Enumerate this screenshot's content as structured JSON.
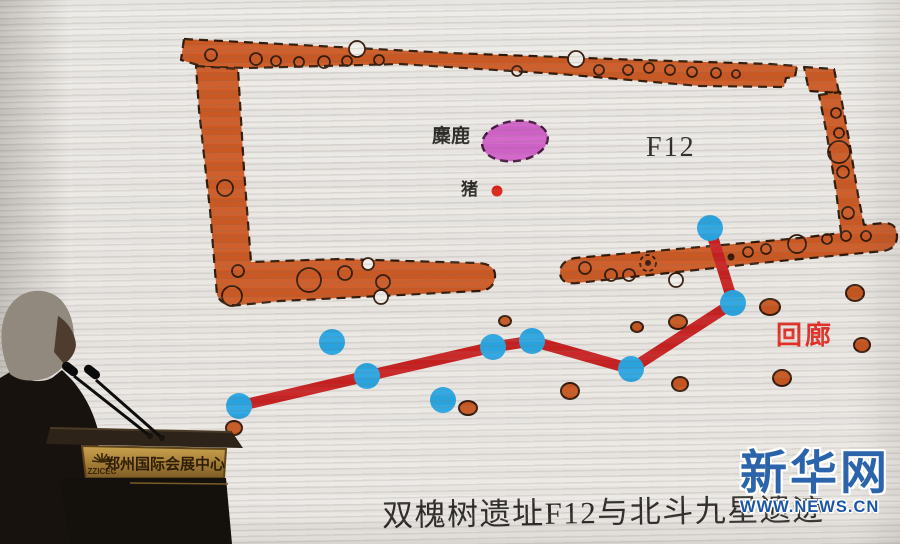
{
  "slide": {
    "caption": "双槐树遗址F12与北斗九星遗迹",
    "labels": {
      "elk": "麋鹿",
      "pig": "猪",
      "room": "F12",
      "corridor": "回廊"
    }
  },
  "watermark": {
    "brand": "新华网",
    "url": "WWW.NEWS.CN"
  },
  "podium": {
    "venue_abbr": "ZZICEC",
    "venue_name": "郑州国际会展中心"
  },
  "colors": {
    "screen_bg": "#eae7e3",
    "band_fill": "#cd5a24",
    "band_outline": "#2e1808",
    "posthole_outline": "#32190a",
    "star_fill": "#2aa6e2",
    "line_red": "#c92020",
    "elk_fill": "#d263c9",
    "elk_outline": "#46173f",
    "pig_red": "#dd2317",
    "pit_fill": "#c8561f",
    "pit_outline": "#33190a",
    "corridor_red": "#e33028",
    "caption_ink": "#2b2a28",
    "watermark_blue": "#2b64aa",
    "watermark_url_blue": "#1c57a5",
    "plaque_gold": "#c69c47"
  },
  "diagram": {
    "star_radius": 13,
    "stars": [
      {
        "x": 239,
        "y": 406,
        "connected": true
      },
      {
        "x": 367,
        "y": 376,
        "connected": true
      },
      {
        "x": 493,
        "y": 347,
        "connected": true
      },
      {
        "x": 532,
        "y": 341,
        "connected": true
      },
      {
        "x": 631,
        "y": 369,
        "connected": true
      },
      {
        "x": 733,
        "y": 303,
        "connected": true
      },
      {
        "x": 710,
        "y": 228,
        "connected": true
      },
      {
        "x": 332,
        "y": 342,
        "connected": false
      },
      {
        "x": 443,
        "y": 400,
        "connected": false
      }
    ],
    "connection_order": [
      0,
      1,
      2,
      3,
      4,
      5,
      6
    ],
    "pits": [
      {
        "x": 234,
        "y": 428,
        "rx": 8,
        "ry": 7
      },
      {
        "x": 505,
        "y": 321,
        "rx": 6,
        "ry": 5
      },
      {
        "x": 468,
        "y": 408,
        "rx": 9,
        "ry": 7
      },
      {
        "x": 570,
        "y": 391,
        "rx": 9,
        "ry": 8
      },
      {
        "x": 637,
        "y": 327,
        "rx": 6,
        "ry": 5
      },
      {
        "x": 678,
        "y": 322,
        "rx": 9,
        "ry": 7
      },
      {
        "x": 680,
        "y": 384,
        "rx": 8,
        "ry": 7
      },
      {
        "x": 770,
        "y": 307,
        "rx": 10,
        "ry": 8
      },
      {
        "x": 855,
        "y": 293,
        "rx": 9,
        "ry": 8
      },
      {
        "x": 862,
        "y": 345,
        "rx": 8,
        "ry": 7
      },
      {
        "x": 782,
        "y": 378,
        "rx": 9,
        "ry": 8
      }
    ],
    "elk_area": {
      "cx": 515,
      "cy": 141,
      "rx": 33,
      "ry": 20
    },
    "pig_dot": {
      "cx": 497,
      "cy": 191,
      "r": 5.5
    }
  }
}
